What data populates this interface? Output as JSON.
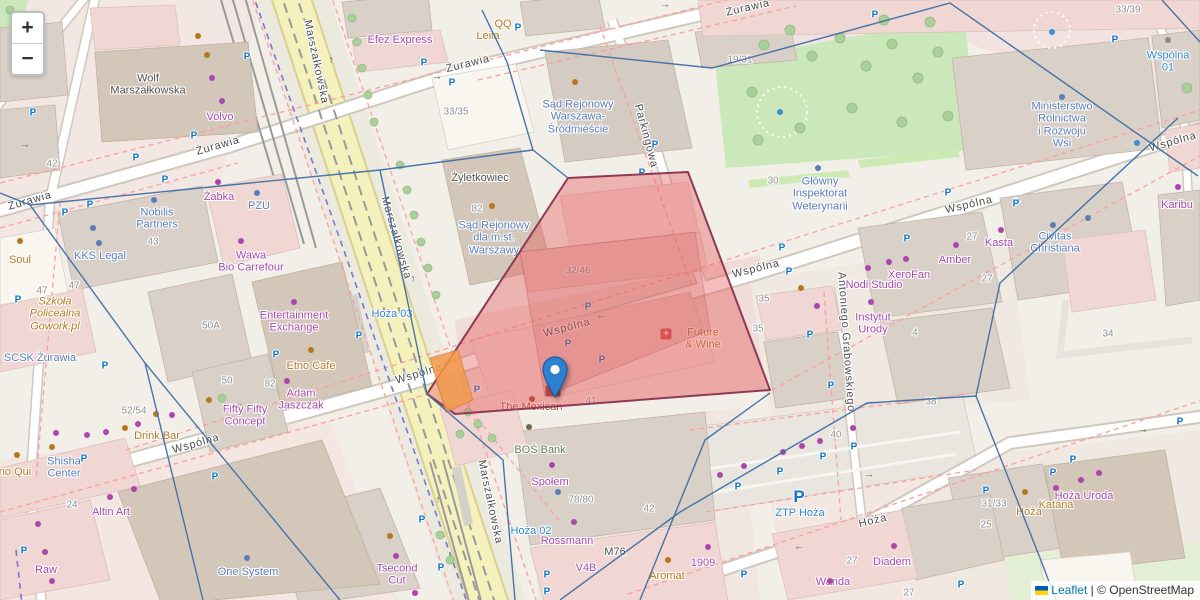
{
  "controls": {
    "zoom_in": "+",
    "zoom_out": "−"
  },
  "attribution": {
    "flag": "ukraine-flag",
    "leaflet": "Leaflet",
    "separator": " | ",
    "copyright": "© OpenStreetMap"
  },
  "marker": {
    "x": 555,
    "y": 397
  },
  "colors": {
    "shop": "#ab47ab",
    "amenity": "#b5781f",
    "office": "#5a7cb8",
    "transit": "#2d86cc",
    "street": "#4c4c4c",
    "number": "#8f8f8f",
    "parking": "#0d74c8",
    "water": "#3f8fd4",
    "highlight_fill": "#e55a5a",
    "highlight_stroke": "#8e3a55",
    "boundary": "#3f6ea6",
    "marker": "#2e81cf"
  },
  "labels": [
    {
      "t": "Żurawia",
      "x": 30,
      "y": 201,
      "c": "st",
      "r": -16
    },
    {
      "t": "Żurawia",
      "x": 218,
      "y": 146,
      "c": "st",
      "r": -16
    },
    {
      "t": "Żurawia",
      "x": 468,
      "y": 64,
      "c": "st",
      "r": -14
    },
    {
      "t": "Żurawia",
      "x": 748,
      "y": 8,
      "c": "st",
      "r": -13
    },
    {
      "t": "Marszałkowska",
      "x": 316,
      "y": 62,
      "c": "st",
      "r": 78
    },
    {
      "t": "Marszałkowska",
      "x": 396,
      "y": 238,
      "c": "st",
      "r": 74
    },
    {
      "t": "Marszałkowska",
      "x": 490,
      "y": 502,
      "c": "st",
      "r": 78
    },
    {
      "t": "Wspólna",
      "x": 196,
      "y": 444,
      "c": "st",
      "r": -16
    },
    {
      "t": "Wspólna",
      "x": 419,
      "y": 374,
      "c": "st",
      "r": -17
    },
    {
      "t": "Wspólna",
      "x": 567,
      "y": 328,
      "c": "st",
      "r": -15
    },
    {
      "t": "Wspólna",
      "x": 756,
      "y": 269,
      "c": "st",
      "r": -14
    },
    {
      "t": "Wspólna",
      "x": 969,
      "y": 205,
      "c": "st",
      "r": -13
    },
    {
      "t": "Wspólna",
      "x": 1173,
      "y": 142,
      "c": "st",
      "r": -16
    },
    {
      "t": "Hoża",
      "x": 873,
      "y": 521,
      "c": "st",
      "r": -14
    },
    {
      "t": "Parkingowa",
      "x": 646,
      "y": 136,
      "c": "st",
      "r": 75
    },
    {
      "t": "Antoniego Grabowskiego",
      "x": 846,
      "y": 342,
      "c": "st",
      "r": 86
    },
    {
      "t": "Wspólna\n01",
      "x": 1168,
      "y": 62,
      "c": "tr"
    },
    {
      "t": "Hoża 02",
      "x": 531,
      "y": 531,
      "c": "tr"
    },
    {
      "t": "Hoża 03",
      "x": 392,
      "y": 314,
      "c": "tr"
    },
    {
      "t": "ZTP Hoża",
      "x": 800,
      "y": 513,
      "c": "tr"
    },
    {
      "t": "Sąd Rejonowy\nWarszawa-\nŚródmieście",
      "x": 578,
      "y": 117,
      "c": "of"
    },
    {
      "t": "Sąd Rejonowy\ndla m.st.\nWarszawy",
      "x": 494,
      "y": 238,
      "c": "of"
    },
    {
      "t": "Nobilis\nPartners",
      "x": 157,
      "y": 219,
      "c": "of"
    },
    {
      "t": "KKS Legal",
      "x": 100,
      "y": 256,
      "c": "of"
    },
    {
      "t": "SCSK Żurawia",
      "x": 40,
      "y": 358,
      "c": "of"
    },
    {
      "t": "Shisha\nCenter",
      "x": 64,
      "y": 468,
      "c": "of"
    },
    {
      "t": "One System",
      "x": 248,
      "y": 572,
      "c": "of"
    },
    {
      "t": "Civitas\nChristiana",
      "x": 1055,
      "y": 243,
      "c": "of"
    },
    {
      "t": "Ministerstwo\nRolnictwa\ni Rozwoju\nWsi",
      "x": 1062,
      "y": 125,
      "c": "of"
    },
    {
      "t": "Główny\nInspektorat\nWeterynarii",
      "x": 820,
      "y": 194,
      "c": "of"
    },
    {
      "t": "PZU",
      "x": 259,
      "y": 206,
      "c": "of"
    },
    {
      "t": "Efez Express",
      "x": 400,
      "y": 40,
      "c": "sh"
    },
    {
      "t": "Żabka",
      "x": 219,
      "y": 197,
      "c": "sh"
    },
    {
      "t": "Wawa\nBio Carrefour",
      "x": 251,
      "y": 262,
      "c": "sh"
    },
    {
      "t": "Entertainment\nExchange",
      "x": 294,
      "y": 322,
      "c": "sh"
    },
    {
      "t": "Adam\nJaszczak",
      "x": 301,
      "y": 400,
      "c": "sh"
    },
    {
      "t": "Fifty Fifty\nConcept",
      "x": 245,
      "y": 416,
      "c": "sh"
    },
    {
      "t": "Altin Art",
      "x": 111,
      "y": 512,
      "c": "sh"
    },
    {
      "t": "Raw",
      "x": 46,
      "y": 570,
      "c": "sh"
    },
    {
      "t": "Tsecond\nCut",
      "x": 397,
      "y": 575,
      "c": "sh"
    },
    {
      "t": "Volvo",
      "x": 220,
      "y": 117,
      "c": "sh"
    },
    {
      "t": "Społem",
      "x": 550,
      "y": 482,
      "c": "sh"
    },
    {
      "t": "Rossmann",
      "x": 567,
      "y": 541,
      "c": "sh"
    },
    {
      "t": "V4B",
      "x": 586,
      "y": 568,
      "c": "sh"
    },
    {
      "t": "1909",
      "x": 703,
      "y": 563,
      "c": "sh"
    },
    {
      "t": "Diadem",
      "x": 892,
      "y": 562,
      "c": "sh"
    },
    {
      "t": "Wanda",
      "x": 833,
      "y": 582,
      "c": "sh"
    },
    {
      "t": "Hoża Uroda",
      "x": 1084,
      "y": 496,
      "c": "sh"
    },
    {
      "t": "Karibu",
      "x": 1177,
      "y": 205,
      "c": "sh"
    },
    {
      "t": "Kasta",
      "x": 999,
      "y": 243,
      "c": "sh"
    },
    {
      "t": "Amber",
      "x": 955,
      "y": 260,
      "c": "sh"
    },
    {
      "t": "XeroFan",
      "x": 909,
      "y": 275,
      "c": "sh"
    },
    {
      "t": "Nodi Studio",
      "x": 874,
      "y": 285,
      "c": "sh"
    },
    {
      "t": "Instytut\nUrody",
      "x": 873,
      "y": 324,
      "c": "sh"
    },
    {
      "t": "Leila",
      "x": 488,
      "y": 36,
      "c": "am"
    },
    {
      "t": "QQ",
      "x": 503,
      "y": 24,
      "c": "am"
    },
    {
      "t": "Drink Bar",
      "x": 157,
      "y": 436,
      "c": "am"
    },
    {
      "t": "Soul",
      "x": 20,
      "y": 260,
      "c": "am"
    },
    {
      "t": "no Qui",
      "x": 15,
      "y": 472,
      "c": "am"
    },
    {
      "t": "Etno Cafe",
      "x": 311,
      "y": 366,
      "c": "am"
    },
    {
      "t": "Aromat",
      "x": 667,
      "y": 576,
      "c": "am"
    },
    {
      "t": "Future\n& Wine",
      "x": 703,
      "y": 339,
      "c": "am"
    },
    {
      "t": "Hoża",
      "x": 1029,
      "y": 512,
      "c": "am"
    },
    {
      "t": "Katana",
      "x": 1056,
      "y": 505,
      "c": "am"
    },
    {
      "t": "Szkoła\nPolicealna\nGowork.pl",
      "x": 55,
      "y": 314,
      "c": "am",
      "i": 1
    },
    {
      "t": "The Mexican",
      "x": 531,
      "y": 407,
      "c": "rs"
    },
    {
      "t": "BOŚ Bank",
      "x": 540,
      "y": 450,
      "c": "gr"
    },
    {
      "t": "Wolf\nMarszałkowska",
      "x": 148,
      "y": 85,
      "c": "bd"
    },
    {
      "t": "Żyletkowiec",
      "x": 480,
      "y": 178,
      "c": "bd"
    },
    {
      "t": "M76",
      "x": 615,
      "y": 552,
      "c": "bd"
    },
    {
      "t": "42",
      "x": 52,
      "y": 164,
      "c": "nm"
    },
    {
      "t": "33/35",
      "x": 456,
      "y": 112,
      "c": "nm"
    },
    {
      "t": "82",
      "x": 477,
      "y": 209,
      "c": "nm"
    },
    {
      "t": "19/31",
      "x": 740,
      "y": 60,
      "c": "nm"
    },
    {
      "t": "33/39",
      "x": 1128,
      "y": 10,
      "c": "nm"
    },
    {
      "t": "30",
      "x": 773,
      "y": 181,
      "c": "nm"
    },
    {
      "t": "43",
      "x": 153,
      "y": 242,
      "c": "nm"
    },
    {
      "t": "47",
      "x": 42,
      "y": 291,
      "c": "nm"
    },
    {
      "t": "47",
      "x": 74,
      "y": 286,
      "c": "nm"
    },
    {
      "t": "50A",
      "x": 211,
      "y": 326,
      "c": "nm"
    },
    {
      "t": "50",
      "x": 227,
      "y": 381,
      "c": "nm"
    },
    {
      "t": "52/54",
      "x": 134,
      "y": 411,
      "c": "nm"
    },
    {
      "t": "82",
      "x": 270,
      "y": 384,
      "c": "nm"
    },
    {
      "t": "24",
      "x": 72,
      "y": 505,
      "c": "nm"
    },
    {
      "t": "32/46",
      "x": 578,
      "y": 271,
      "c": "nm"
    },
    {
      "t": "41",
      "x": 591,
      "y": 401,
      "c": "nm"
    },
    {
      "t": "35",
      "x": 764,
      "y": 299,
      "c": "nm"
    },
    {
      "t": "35",
      "x": 758,
      "y": 329,
      "c": "nm"
    },
    {
      "t": "4",
      "x": 915,
      "y": 333,
      "c": "nm"
    },
    {
      "t": "27",
      "x": 972,
      "y": 237,
      "c": "nm"
    },
    {
      "t": "27",
      "x": 987,
      "y": 279,
      "c": "nm"
    },
    {
      "t": "34",
      "x": 1108,
      "y": 334,
      "c": "nm"
    },
    {
      "t": "78/80",
      "x": 581,
      "y": 500,
      "c": "nm"
    },
    {
      "t": "42",
      "x": 649,
      "y": 509,
      "c": "nm"
    },
    {
      "t": "40",
      "x": 836,
      "y": 435,
      "c": "nm"
    },
    {
      "t": "38",
      "x": 931,
      "y": 402,
      "c": "nm"
    },
    {
      "t": "27",
      "x": 852,
      "y": 561,
      "c": "nm"
    },
    {
      "t": "27",
      "x": 909,
      "y": 593,
      "c": "nm"
    },
    {
      "t": "25",
      "x": 986,
      "y": 525,
      "c": "nm"
    },
    {
      "t": "31/33",
      "x": 994,
      "y": 504,
      "c": "nm"
    }
  ],
  "icons": {
    "parking": [
      [
        33,
        113
      ],
      [
        194,
        136
      ],
      [
        136,
        158
      ],
      [
        247,
        57
      ],
      [
        424,
        63
      ],
      [
        452,
        83
      ],
      [
        518,
        28
      ],
      [
        655,
        145
      ],
      [
        642,
        173
      ],
      [
        875,
        15
      ],
      [
        948,
        193
      ],
      [
        1017,
        203
      ],
      [
        1115,
        40
      ],
      [
        165,
        180
      ],
      [
        90,
        205
      ],
      [
        65,
        213
      ],
      [
        18,
        300
      ],
      [
        588,
        307
      ],
      [
        568,
        344
      ],
      [
        602,
        360
      ],
      [
        477,
        390
      ],
      [
        547,
        575
      ],
      [
        547,
        592
      ],
      [
        422,
        520
      ],
      [
        441,
        568
      ],
      [
        84,
        459
      ],
      [
        215,
        477
      ],
      [
        24,
        551
      ],
      [
        105,
        366
      ],
      [
        276,
        355
      ],
      [
        359,
        336
      ],
      [
        782,
        248
      ],
      [
        789,
        272
      ],
      [
        907,
        239
      ],
      [
        810,
        335
      ],
      [
        831,
        386
      ],
      [
        1053,
        473
      ],
      [
        1073,
        460
      ],
      [
        986,
        491
      ],
      [
        1180,
        422
      ],
      [
        961,
        585
      ],
      [
        823,
        457
      ],
      [
        854,
        447
      ],
      [
        780,
        472
      ],
      [
        738,
        487
      ],
      [
        744,
        575
      ],
      [
        1016,
        204
      ]
    ],
    "parking_large": [
      [
        799,
        497
      ]
    ],
    "shop_dots": [
      [
        218,
        182
      ],
      [
        241,
        241
      ],
      [
        294,
        302
      ],
      [
        287,
        381
      ],
      [
        138,
        424
      ],
      [
        172,
        415
      ],
      [
        56,
        433
      ],
      [
        87,
        435
      ],
      [
        106,
        432
      ],
      [
        38,
        524
      ],
      [
        45,
        552
      ],
      [
        134,
        489
      ],
      [
        110,
        497
      ],
      [
        52,
        581
      ],
      [
        396,
        556
      ],
      [
        415,
        593
      ],
      [
        552,
        465
      ],
      [
        574,
        522
      ],
      [
        708,
        547
      ],
      [
        894,
        546
      ],
      [
        830,
        581
      ],
      [
        1081,
        480
      ],
      [
        1099,
        473
      ],
      [
        1056,
        488
      ],
      [
        906,
        259
      ],
      [
        889,
        262
      ],
      [
        868,
        268
      ],
      [
        956,
        245
      ],
      [
        1001,
        230
      ],
      [
        871,
        302
      ],
      [
        817,
        306
      ],
      [
        1178,
        187
      ],
      [
        720,
        475
      ],
      [
        744,
        466
      ],
      [
        783,
        452
      ],
      [
        802,
        446
      ],
      [
        820,
        441
      ],
      [
        853,
        428
      ],
      [
        212,
        78
      ],
      [
        222,
        101
      ]
    ],
    "amenity_dots": [
      [
        20,
        241
      ],
      [
        125,
        428
      ],
      [
        156,
        414
      ],
      [
        17,
        455
      ],
      [
        52,
        447
      ],
      [
        209,
        400
      ],
      [
        198,
        36
      ],
      [
        207,
        55
      ],
      [
        311,
        350
      ],
      [
        668,
        560
      ],
      [
        1025,
        492
      ],
      [
        575,
        82
      ],
      [
        492,
        206
      ],
      [
        801,
        288
      ],
      [
        390,
        536
      ]
    ],
    "office_dots": [
      [
        154,
        200
      ],
      [
        93,
        228
      ],
      [
        99,
        243
      ],
      [
        257,
        193
      ],
      [
        818,
        168
      ],
      [
        1062,
        97
      ],
      [
        247,
        558
      ],
      [
        1053,
        225
      ],
      [
        1088,
        218
      ],
      [
        558,
        492
      ]
    ],
    "water_dots": [
      [
        780,
        112
      ],
      [
        1052,
        32
      ],
      [
        1137,
        143
      ]
    ],
    "misc_dots": [
      {
        "x": 1168,
        "y": 40,
        "c": "#8c8c8c"
      },
      {
        "x": 529,
        "y": 427,
        "c": "#6b6f52"
      },
      {
        "x": 532,
        "y": 399,
        "c": "#a84430"
      }
    ],
    "pharmacy_cross": {
      "x": 666,
      "y": 334,
      "ch": "+"
    },
    "envelope": {
      "x": 553,
      "y": 391
    },
    "arrows": [
      [
        25,
        145,
        "→"
      ],
      [
        437,
        77,
        "→"
      ],
      [
        665,
        5,
        "→"
      ],
      [
        331,
        60,
        "↑"
      ],
      [
        413,
        279,
        "↑"
      ],
      [
        438,
        500,
        "↑"
      ],
      [
        601,
        316,
        "←"
      ],
      [
        869,
        475,
        "→"
      ],
      [
        1143,
        430,
        "→"
      ],
      [
        799,
        547,
        "←"
      ]
    ]
  }
}
